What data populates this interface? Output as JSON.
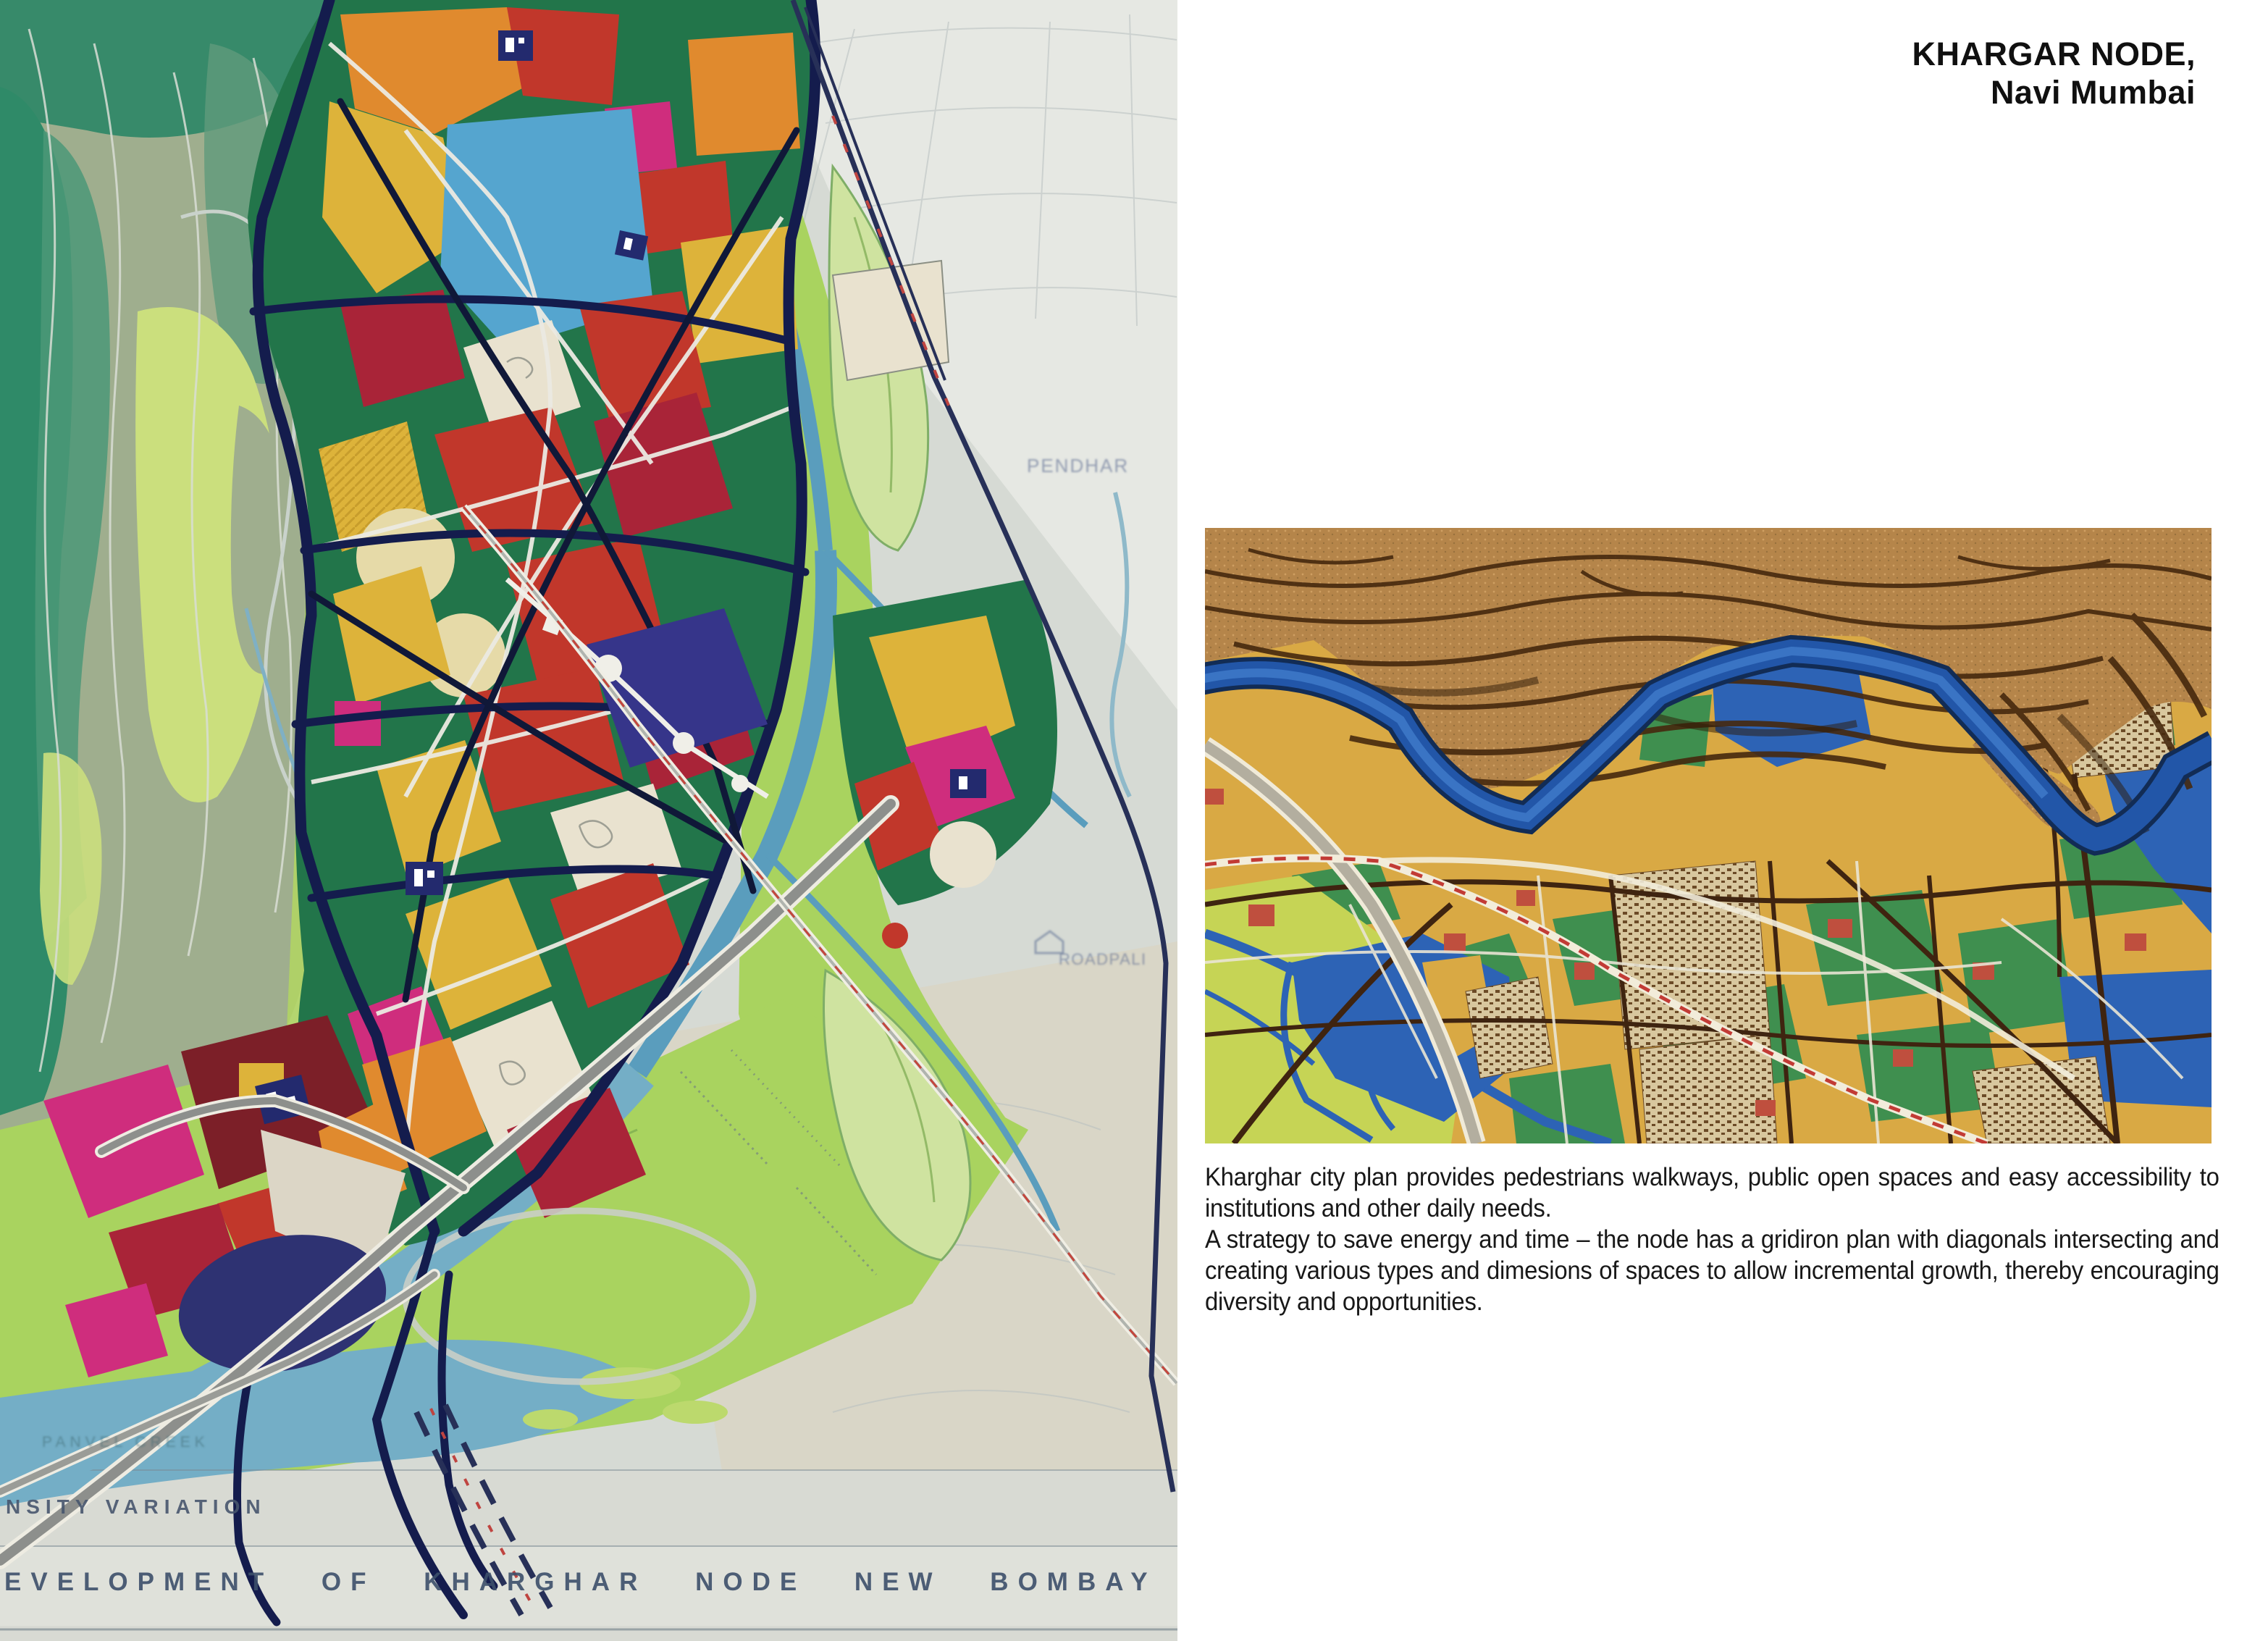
{
  "page": {
    "background_color": "#ffffff"
  },
  "header": {
    "title_line1": "KHARGAR NODE,",
    "title_line2": "Navi Mumbai"
  },
  "caption": {
    "para1": "Kharghar city plan provides pedestrians walkways, public open spaces and easy accessibility to institutions and other daily needs.",
    "para2": "A strategy to save energy and time – the node has a gridiron plan with diagonals intersecting and creating various types and dimesions of spaces to allow incremental growth, thereby encouraging diversity and opportunities."
  },
  "map": {
    "footer_label_1": "NSITY VARIATION",
    "footer_label_2": "EVELOPMENT OF KHARGHAR NODE NEW BOMBAY",
    "labels": {
      "village_ne": "PENDHAR",
      "village_e": "ROADPALI",
      "creek": "PANVEL CREEK"
    }
  },
  "palette": {
    "map_paper": "#d6dad4",
    "map_hills_teal": "#2f8a68",
    "map_plain_green": "#a9d35f",
    "map_core_green": "#22754a",
    "map_gold": "#ddb33a",
    "map_orange": "#e08a2e",
    "map_red": "#c1372b",
    "map_crimson": "#a92438",
    "map_magenta": "#cf2d7d",
    "map_lake_blue": "#55a5cf",
    "map_road_navy": "#141c4d",
    "model_cork": "#b5854a",
    "model_contour": "#46290e",
    "model_river_blue": "#2256a8",
    "model_block_gold": "#d9a944",
    "model_green": "#3f8f4f",
    "model_meadow": "#c6d455"
  }
}
